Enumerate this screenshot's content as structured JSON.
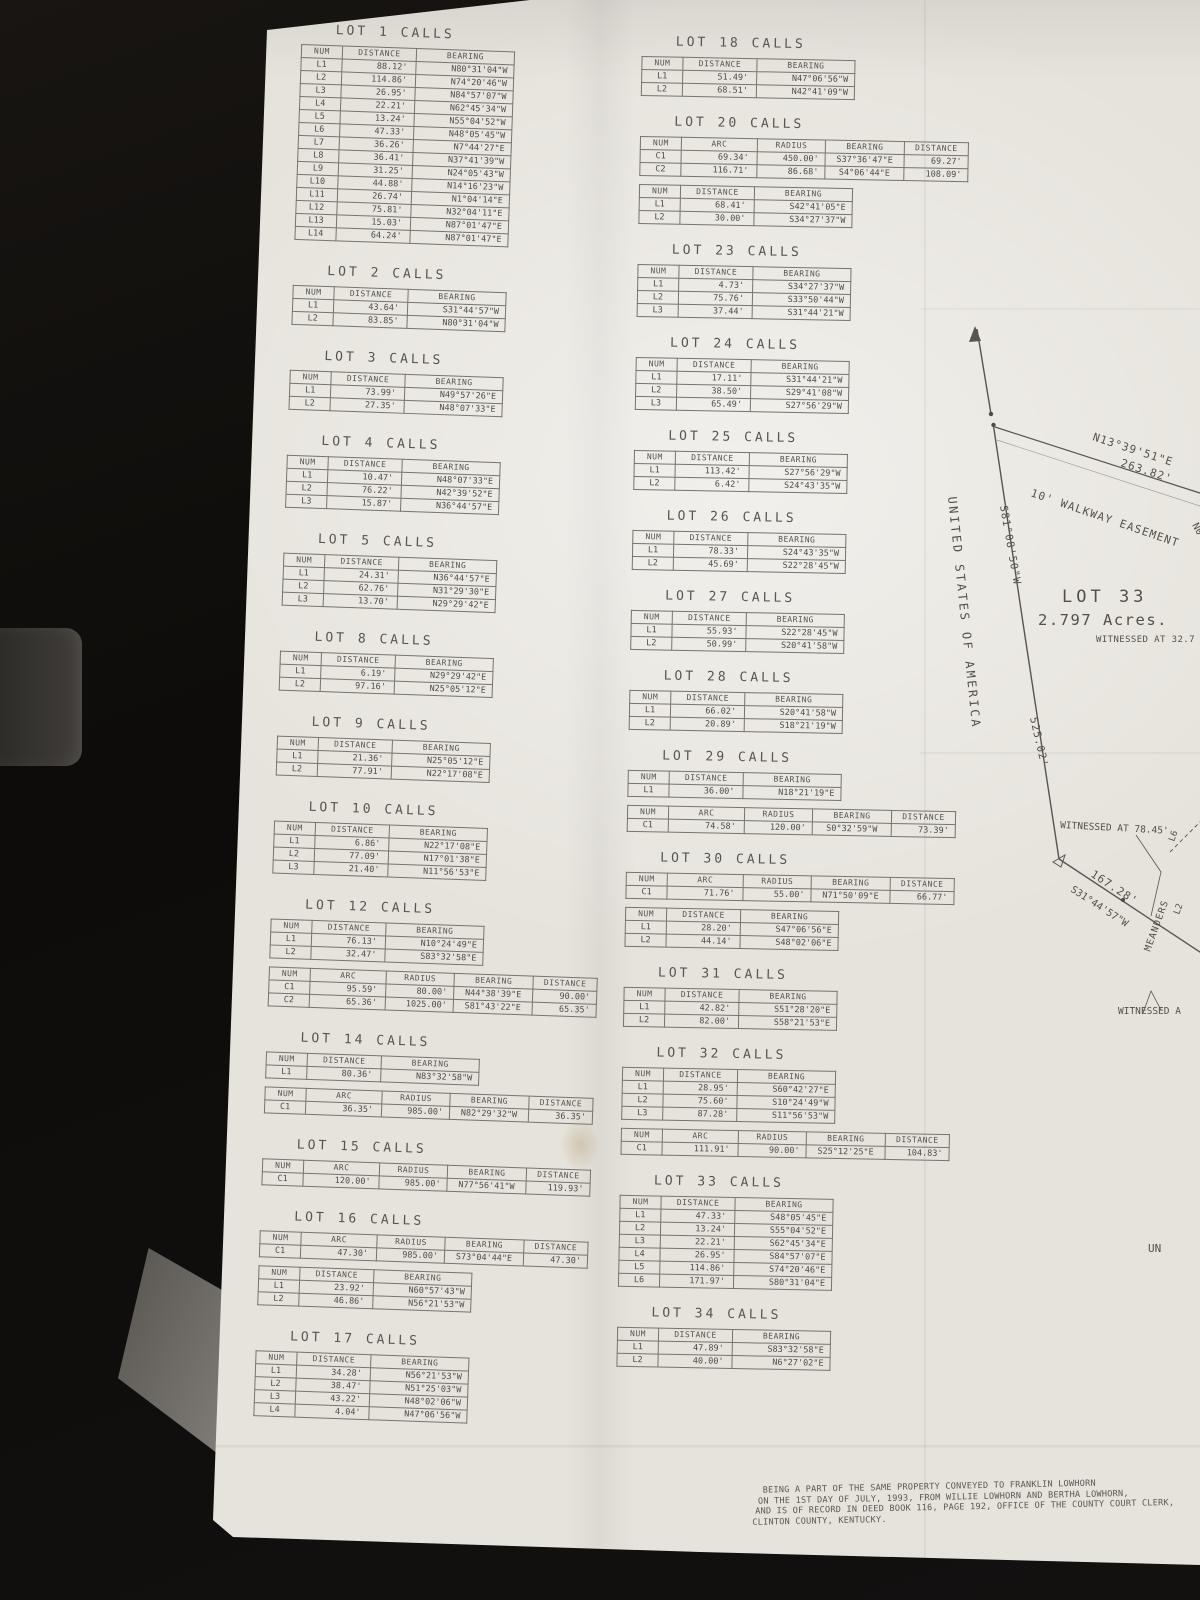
{
  "table_headers": {
    "line": [
      "NUM",
      "DISTANCE",
      "BEARING"
    ],
    "curve": [
      "NUM",
      "ARC",
      "RADIUS",
      "BEARING",
      "DISTANCE"
    ]
  },
  "lots_left": [
    {
      "title": "LOT 1 CALLS",
      "tables": [
        {
          "kind": "line",
          "rows": [
            [
              "L1",
              "88.12'",
              "N80°31'04\"W"
            ],
            [
              "L2",
              "114.86'",
              "N74°20'46\"W"
            ],
            [
              "L3",
              "26.95'",
              "N84°57'07\"W"
            ],
            [
              "L4",
              "22.21'",
              "N62°45'34\"W"
            ],
            [
              "L5",
              "13.24'",
              "N55°04'52\"W"
            ],
            [
              "L6",
              "47.33'",
              "N48°05'45\"W"
            ],
            [
              "L7",
              "36.26'",
              "N7°44'27\"E"
            ],
            [
              "L8",
              "36.41'",
              "N37°41'39\"W"
            ],
            [
              "L9",
              "31.25'",
              "N24°05'43\"W"
            ],
            [
              "L10",
              "44.88'",
              "N14°16'23\"W"
            ],
            [
              "L11",
              "26.74'",
              "N1°04'14\"E"
            ],
            [
              "L12",
              "75.81'",
              "N32°04'11\"E"
            ],
            [
              "L13",
              "15.03'",
              "N87°01'47\"E"
            ],
            [
              "L14",
              "64.24'",
              "N87°01'47\"E"
            ]
          ]
        }
      ]
    },
    {
      "title": "LOT 2 CALLS",
      "tables": [
        {
          "kind": "line",
          "rows": [
            [
              "L1",
              "43.64'",
              "S31°44'57\"W"
            ],
            [
              "L2",
              "83.85'",
              "N80°31'04\"W"
            ]
          ]
        }
      ]
    },
    {
      "title": "LOT 3 CALLS",
      "tables": [
        {
          "kind": "line",
          "rows": [
            [
              "L1",
              "73.99'",
              "N49°57'26\"E"
            ],
            [
              "L2",
              "27.35'",
              "N48°07'33\"E"
            ]
          ]
        }
      ]
    },
    {
      "title": "LOT 4 CALLS",
      "tables": [
        {
          "kind": "line",
          "rows": [
            [
              "L1",
              "10.47'",
              "N48°07'33\"E"
            ],
            [
              "L2",
              "76.22'",
              "N42°39'52\"E"
            ],
            [
              "L3",
              "15.87'",
              "N36°44'57\"E"
            ]
          ]
        }
      ]
    },
    {
      "title": "LOT 5 CALLS",
      "tables": [
        {
          "kind": "line",
          "rows": [
            [
              "L1",
              "24.31'",
              "N36°44'57\"E"
            ],
            [
              "L2",
              "62.76'",
              "N31°29'30\"E"
            ],
            [
              "L3",
              "13.70'",
              "N29°29'42\"E"
            ]
          ]
        }
      ]
    },
    {
      "title": "LOT 8 CALLS",
      "tables": [
        {
          "kind": "line",
          "rows": [
            [
              "L1",
              "6.19'",
              "N29°29'42\"E"
            ],
            [
              "L2",
              "97.16'",
              "N25°05'12\"E"
            ]
          ]
        }
      ]
    },
    {
      "title": "LOT 9 CALLS",
      "tables": [
        {
          "kind": "line",
          "rows": [
            [
              "L1",
              "21.36'",
              "N25°05'12\"E"
            ],
            [
              "L2",
              "77.91'",
              "N22°17'08\"E"
            ]
          ]
        }
      ]
    },
    {
      "title": "LOT 10 CALLS",
      "tables": [
        {
          "kind": "line",
          "rows": [
            [
              "L1",
              "6.86'",
              "N22°17'08\"E"
            ],
            [
              "L2",
              "77.09'",
              "N17°01'38\"E"
            ],
            [
              "L3",
              "21.40'",
              "N11°56'53\"E"
            ]
          ]
        }
      ]
    },
    {
      "title": "LOT 12 CALLS",
      "tables": [
        {
          "kind": "line",
          "rows": [
            [
              "L1",
              "76.13'",
              "N10°24'49\"E"
            ],
            [
              "L2",
              "32.47'",
              "S83°32'58\"E"
            ]
          ]
        },
        {
          "kind": "curve",
          "rows": [
            [
              "C1",
              "95.59'",
              "80.00'",
              "N44°38'39\"E",
              "90.00'"
            ],
            [
              "C2",
              "65.36'",
              "1025.00'",
              "S81°43'22\"E",
              "65.35'"
            ]
          ]
        }
      ]
    },
    {
      "title": "LOT 14 CALLS",
      "tables": [
        {
          "kind": "line",
          "rows": [
            [
              "L1",
              "80.36'",
              "N83°32'58\"W"
            ]
          ]
        },
        {
          "kind": "curve",
          "rows": [
            [
              "C1",
              "36.35'",
              "985.00'",
              "N82°29'32\"W",
              "36.35'"
            ]
          ]
        }
      ]
    },
    {
      "title": "LOT 15 CALLS",
      "tables": [
        {
          "kind": "curve",
          "rows": [
            [
              "C1",
              "120.00'",
              "985.00'",
              "N77°56'41\"W",
              "119.93'"
            ]
          ]
        }
      ]
    },
    {
      "title": "LOT 16 CALLS",
      "tables": [
        {
          "kind": "curve",
          "rows": [
            [
              "C1",
              "47.30'",
              "985.00'",
              "S73°04'44\"E",
              "47.30'"
            ]
          ]
        },
        {
          "kind": "line",
          "rows": [
            [
              "L1",
              "23.92'",
              "N60°57'43\"W"
            ],
            [
              "L2",
              "46.86'",
              "N56°21'53\"W"
            ]
          ]
        }
      ]
    },
    {
      "title": "LOT 17 CALLS",
      "tables": [
        {
          "kind": "line",
          "rows": [
            [
              "L1",
              "34.28'",
              "N56°21'53\"W"
            ],
            [
              "L2",
              "38.47'",
              "N51°25'03\"W"
            ],
            [
              "L3",
              "43.22'",
              "N48°02'06\"W"
            ],
            [
              "L4",
              "4.04'",
              "N47°06'56\"W"
            ]
          ]
        }
      ]
    }
  ],
  "lots_right": [
    {
      "title": "LOT 18 CALLS",
      "tables": [
        {
          "kind": "line",
          "rows": [
            [
              "L1",
              "51.49'",
              "N47°06'56\"W"
            ],
            [
              "L2",
              "68.51'",
              "N42°41'09\"W"
            ]
          ]
        }
      ]
    },
    {
      "title": "LOT 20 CALLS",
      "tables": [
        {
          "kind": "curve",
          "rows": [
            [
              "C1",
              "69.34'",
              "450.00'",
              "S37°36'47\"E",
              "69.27'"
            ],
            [
              "C2",
              "116.71'",
              "86.68'",
              "S4°06'44\"E",
              "108.09'"
            ]
          ]
        },
        {
          "kind": "line",
          "rows": [
            [
              "L1",
              "68.41'",
              "S42°41'05\"E"
            ],
            [
              "L2",
              "30.00'",
              "S34°27'37\"W"
            ]
          ]
        }
      ]
    },
    {
      "title": "LOT 23 CALLS",
      "tables": [
        {
          "kind": "line",
          "rows": [
            [
              "L1",
              "4.73'",
              "S34°27'37\"W"
            ],
            [
              "L2",
              "75.76'",
              "S33°50'44\"W"
            ],
            [
              "L3",
              "37.44'",
              "S31°44'21\"W"
            ]
          ]
        }
      ]
    },
    {
      "title": "LOT 24 CALLS",
      "tables": [
        {
          "kind": "line",
          "rows": [
            [
              "L1",
              "17.11'",
              "S31°44'21\"W"
            ],
            [
              "L2",
              "38.50'",
              "S29°41'08\"W"
            ],
            [
              "L3",
              "65.49'",
              "S27°56'29\"W"
            ]
          ]
        }
      ]
    },
    {
      "title": "LOT 25 CALLS",
      "tables": [
        {
          "kind": "line",
          "rows": [
            [
              "L1",
              "113.42'",
              "S27°56'29\"W"
            ],
            [
              "L2",
              "6.42'",
              "S24°43'35\"W"
            ]
          ]
        }
      ]
    },
    {
      "title": "LOT 26 CALLS",
      "tables": [
        {
          "kind": "line",
          "rows": [
            [
              "L1",
              "78.33'",
              "S24°43'35\"W"
            ],
            [
              "L2",
              "45.69'",
              "S22°28'45\"W"
            ]
          ]
        }
      ]
    },
    {
      "title": "LOT 27 CALLS",
      "tables": [
        {
          "kind": "line",
          "rows": [
            [
              "L1",
              "55.93'",
              "S22°28'45\"W"
            ],
            [
              "L2",
              "50.99'",
              "S20°41'58\"W"
            ]
          ]
        }
      ]
    },
    {
      "title": "LOT 28 CALLS",
      "tables": [
        {
          "kind": "line",
          "rows": [
            [
              "L1",
              "66.02'",
              "S20°41'58\"W"
            ],
            [
              "L2",
              "20.89'",
              "S18°21'19\"W"
            ]
          ]
        }
      ]
    },
    {
      "title": "LOT 29 CALLS",
      "tables": [
        {
          "kind": "line",
          "rows": [
            [
              "L1",
              "36.00'",
              "N18°21'19\"E"
            ]
          ]
        },
        {
          "kind": "curve",
          "rows": [
            [
              "C1",
              "74.58'",
              "120.00'",
              "S0°32'59\"W",
              "73.39'"
            ]
          ]
        }
      ]
    },
    {
      "title": "LOT 30 CALLS",
      "tables": [
        {
          "kind": "curve",
          "rows": [
            [
              "C1",
              "71.76'",
              "55.00'",
              "N71°50'09\"E",
              "66.77'"
            ]
          ]
        },
        {
          "kind": "line",
          "rows": [
            [
              "L1",
              "28.20'",
              "S47°06'56\"E"
            ],
            [
              "L2",
              "44.14'",
              "S48°02'06\"E"
            ]
          ]
        }
      ]
    },
    {
      "title": "LOT 31 CALLS",
      "tables": [
        {
          "kind": "line",
          "rows": [
            [
              "L1",
              "42.82'",
              "S51°28'20\"E"
            ],
            [
              "L2",
              "82.00'",
              "S58°21'53\"E"
            ]
          ]
        }
      ]
    },
    {
      "title": "LOT 32 CALLS",
      "tables": [
        {
          "kind": "line",
          "rows": [
            [
              "L1",
              "28.95'",
              "S60°42'27\"E"
            ],
            [
              "L2",
              "75.60'",
              "S10°24'49\"W"
            ],
            [
              "L3",
              "87.28'",
              "S11°56'53\"W"
            ]
          ]
        },
        {
          "kind": "curve",
          "rows": [
            [
              "C1",
              "111.91'",
              "90.00'",
              "S25°12'25\"E",
              "104.83'"
            ]
          ]
        }
      ]
    },
    {
      "title": "LOT 33 CALLS",
      "tables": [
        {
          "kind": "line",
          "rows": [
            [
              "L1",
              "47.33'",
              "S48°05'45\"E"
            ],
            [
              "L2",
              "13.24'",
              "S55°04'52\"E"
            ],
            [
              "L3",
              "22.21'",
              "S62°45'34\"E"
            ],
            [
              "L4",
              "26.95'",
              "S84°57'07\"E"
            ],
            [
              "L5",
              "114.86'",
              "S74°20'46\"E"
            ],
            [
              "L6",
              "171.97'",
              "S80°31'04\"E"
            ]
          ]
        }
      ]
    },
    {
      "title": "LOT 34 CALLS",
      "tables": [
        {
          "kind": "line",
          "rows": [
            [
              "L1",
              "47.89'",
              "S83°32'58\"E"
            ],
            [
              "L2",
              "40.00'",
              "N6°27'02\"E"
            ]
          ]
        }
      ]
    }
  ],
  "map": {
    "usa": "UNITED STATES OF AMERICA",
    "west_bearing": "S81°08'50\"W",
    "n13_bearing": "N13°39'51\"E",
    "n13_distance": "263.82'",
    "easement": "10' WALKWAY EASEMENT",
    "cut_bearing": "N0",
    "lot33": "LOT 33",
    "acreage": "2.797  Acres.",
    "witnessed_327": "WITNESSED AT 32.7",
    "d525": "525.02'",
    "witnessed_7845": "WITNESSED AT 78.45'",
    "d16728": "167.28'",
    "b314457": "S31°44'57\"W",
    "meanders": "MEANDERS",
    "l2": "L2",
    "l6": "L6",
    "witnessed_a": "WITNESSED A",
    "un": "UN"
  },
  "footer": {
    "lines": [
      "BEING A PART OF THE SAME PROPERTY CONVEYED TO FRANKLIN LOWHORN",
      "ON THE 1ST DAY OF JULY, 1993, FROM WILLIE LOWHORN AND BERTHA LOWHORN,",
      "AND IS OF RECORD IN DEED BOOK 116, PAGE 192, OFFICE OF THE COUNTY COURT CLERK,",
      "CLINTON COUNTY, KENTUCKY."
    ]
  }
}
